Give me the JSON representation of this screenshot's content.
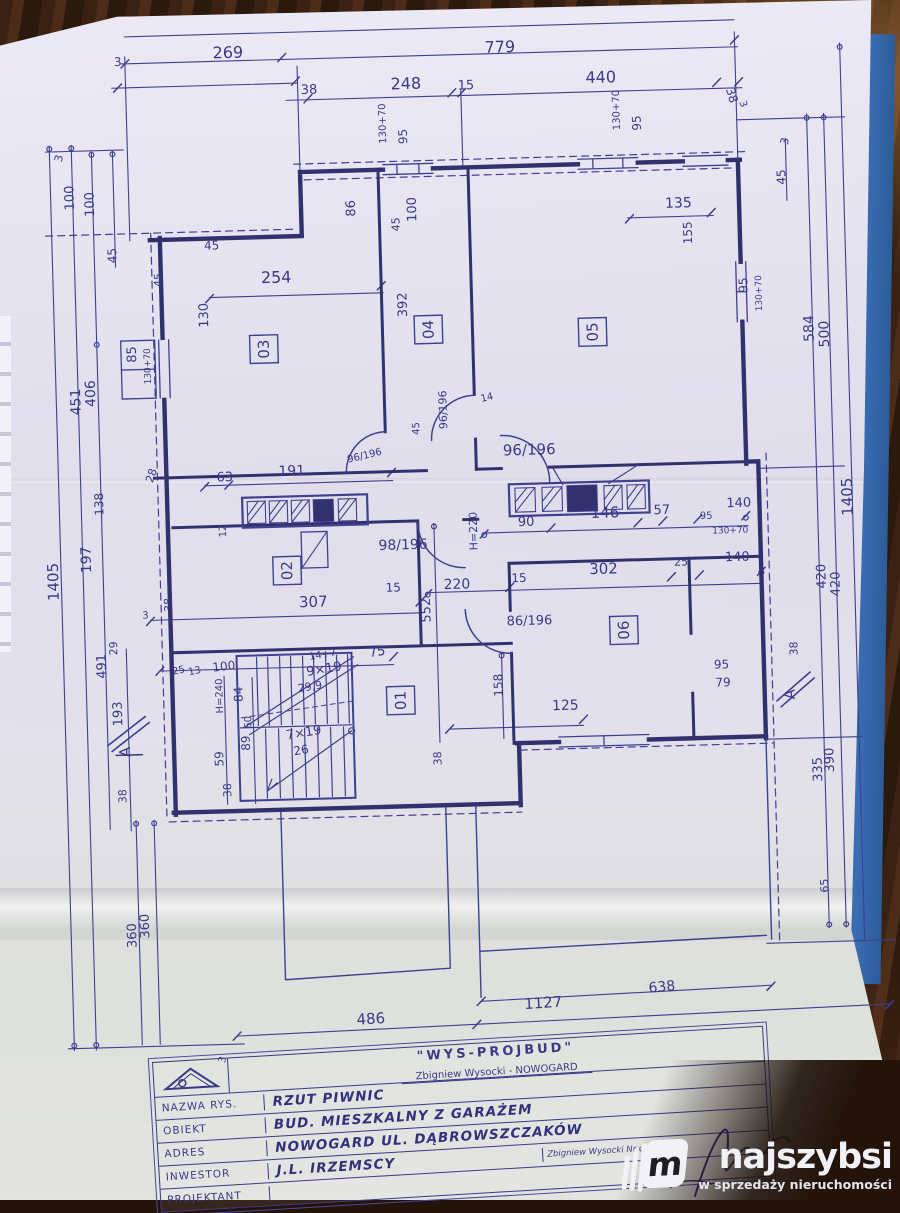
{
  "colors": {
    "ink": "#3a3989",
    "walls": "#32316e",
    "paper": "#e4e1f0",
    "wood": "#3a2114",
    "blue_edge": "#3a6db5",
    "watermark_text": "#f1f1f6"
  },
  "watermark": {
    "logo_letter": "m",
    "brand": "najszybsi",
    "tagline": "w sprzedaży nieruchomości"
  },
  "title_block": {
    "company": "\"WYS-PROJBUD\"",
    "company_sub": "Zbigniew Wysocki - NOWOGARD",
    "rows": [
      {
        "label": "NAZWA RYS.",
        "value": "RZUT PIWNIC"
      },
      {
        "label": "OBIEKT",
        "value": "BUD. MIESZKALNY Z GARAŻEM"
      },
      {
        "label": "ADRES",
        "value": "NOWOGARD UL. DĄBROWSZCZAKÓW"
      },
      {
        "label": "INWESTOR",
        "value": "J.L. IRZEMSCY"
      },
      {
        "label": "PROJEKTANT",
        "value": ""
      }
    ],
    "license_note": "Zbigniew Wysocki  Nr upr. 127/78"
  },
  "plan": {
    "drawing_title": "RZUT PIWNIC",
    "rooms": [
      {
        "id": "03",
        "x": 271,
        "y": 344
      },
      {
        "id": "04",
        "x": 436,
        "y": 329
      },
      {
        "id": "05",
        "x": 600,
        "y": 336
      },
      {
        "id": "02",
        "x": 288,
        "y": 566
      },
      {
        "id": "01",
        "x": 398,
        "y": 699
      },
      {
        "id": "06",
        "x": 623,
        "y": 635
      }
    ],
    "labels": [
      {
        "t": "3",
        "x": 129,
        "y": 57,
        "s": 12
      },
      {
        "t": "269",
        "x": 228,
        "y": 52,
        "s": 16
      },
      {
        "t": "779",
        "x": 500,
        "y": 54,
        "s": 16
      },
      {
        "t": "38",
        "x": 315,
        "y": 90,
        "s": 13
      },
      {
        "t": "248",
        "x": 405,
        "y": 88,
        "s": 16
      },
      {
        "t": "15",
        "x": 472,
        "y": 90,
        "s": 13
      },
      {
        "t": "440",
        "x": 600,
        "y": 87,
        "s": 16
      },
      {
        "t": "38",
        "x": 740,
        "y": 97,
        "r": 75,
        "s": 12
      },
      {
        "t": "3",
        "x": 753,
        "y": 110,
        "r": 75,
        "s": 10
      },
      {
        "t": "130+70",
        "x": 399,
        "y": 142,
        "r": -90,
        "s": 10
      },
      {
        "t": "95",
        "x": 420,
        "y": 143,
        "r": -90,
        "s": 12
      },
      {
        "t": "45",
        "x": 410,
        "y": 230,
        "r": -90,
        "s": 11
      },
      {
        "t": "130+70",
        "x": 633,
        "y": 135,
        "r": -90,
        "s": 10
      },
      {
        "t": "95",
        "x": 654,
        "y": 136,
        "r": -90,
        "s": 12
      },
      {
        "t": "3",
        "x": 800,
        "y": 155,
        "r": -75,
        "s": 11
      },
      {
        "t": "45",
        "x": 797,
        "y": 194,
        "r": -90,
        "s": 12
      },
      {
        "t": "3",
        "x": 74,
        "y": 152,
        "r": -75,
        "s": 11
      },
      {
        "t": "100",
        "x": 85,
        "y": 200,
        "r": -90,
        "s": 13
      },
      {
        "t": "100",
        "x": 105,
        "y": 207,
        "r": -90,
        "s": 13
      },
      {
        "t": "45",
        "x": 126,
        "y": 254,
        "r": -90,
        "s": 12
      },
      {
        "t": "406",
        "x": 101,
        "y": 397,
        "r": -90,
        "s": 14
      },
      {
        "t": "451",
        "x": 86,
        "y": 405,
        "r": -90,
        "s": 14
      },
      {
        "t": "85",
        "x": 143,
        "y": 354,
        "r": -90,
        "s": 13
      },
      {
        "t": "130+70",
        "x": 157,
        "y": 376,
        "r": -90,
        "s": 9
      },
      {
        "t": "45",
        "x": 171,
        "y": 279,
        "r": -90,
        "s": 11
      },
      {
        "t": "138",
        "x": 106,
        "y": 506,
        "r": -90,
        "s": 12
      },
      {
        "t": "197",
        "x": 92,
        "y": 563,
        "r": -90,
        "s": 14
      },
      {
        "t": "1405",
        "x": 59,
        "y": 590,
        "r": -90,
        "s": 15
      },
      {
        "t": "29",
        "x": 116,
        "y": 646,
        "r": -90,
        "s": 11
      },
      {
        "t": "491",
        "x": 104,
        "y": 669,
        "r": -90,
        "s": 13
      },
      {
        "t": "193",
        "x": 119,
        "y": 717,
        "r": -90,
        "s": 13
      },
      {
        "t": "38",
        "x": 121,
        "y": 794,
        "r": -90,
        "s": 11
      },
      {
        "t": "360",
        "x": 140,
        "y": 930,
        "r": -90,
        "s": 13
      },
      {
        "t": "360",
        "x": 127,
        "y": 939,
        "r": -90,
        "s": 13
      },
      {
        "t": "584",
        "x": 821,
        "y": 352,
        "r": -90,
        "s": 14
      },
      {
        "t": "500",
        "x": 836,
        "y": 358,
        "r": -90,
        "s": 14
      },
      {
        "t": "95",
        "x": 756,
        "y": 301,
        "r": -90,
        "s": 12
      },
      {
        "t": "130+70",
        "x": 770,
        "y": 320,
        "r": -90,
        "s": 9
      },
      {
        "t": "155",
        "x": 702,
        "y": 251,
        "r": -90,
        "s": 12
      },
      {
        "t": "135",
        "x": 676,
        "y": 214,
        "s": 14
      },
      {
        "t": "1405",
        "x": 855,
        "y": 527,
        "r": -90,
        "s": 15
      },
      {
        "t": "420",
        "x": 826,
        "y": 599,
        "r": -90,
        "s": 13
      },
      {
        "t": "420",
        "x": 840,
        "y": 607,
        "r": -90,
        "s": 13
      },
      {
        "t": "38",
        "x": 796,
        "y": 665,
        "r": -90,
        "s": 11
      },
      {
        "t": "390",
        "x": 829,
        "y": 783,
        "r": -90,
        "s": 13
      },
      {
        "t": "335",
        "x": 817,
        "y": 792,
        "r": -90,
        "s": 13
      },
      {
        "t": "65",
        "x": 820,
        "y": 903,
        "r": -90,
        "s": 11
      },
      {
        "t": "86",
        "x": 366,
        "y": 214,
        "r": -90,
        "s": 13
      },
      {
        "t": "100",
        "x": 427,
        "y": 221,
        "r": -90,
        "s": 13
      },
      {
        "t": "45",
        "x": 214,
        "y": 243,
        "s": 12
      },
      {
        "t": "254",
        "x": 270,
        "y": 278,
        "s": 16
      },
      {
        "t": "130",
        "x": 216,
        "y": 321,
        "r": -90,
        "s": 13
      },
      {
        "t": "392",
        "x": 415,
        "y": 316,
        "r": -90,
        "s": 13
      },
      {
        "t": "63",
        "x": 220,
        "y": 475,
        "s": 13
      },
      {
        "t": "191",
        "x": 282,
        "y": 471,
        "s": 14
      },
      {
        "t": "96/196",
        "x": 352,
        "y": 460,
        "r": -12,
        "s": 10
      },
      {
        "t": "96/196",
        "x": 452,
        "y": 429,
        "r": -90,
        "s": 11
      },
      {
        "t": "14",
        "x": 487,
        "y": 403,
        "r": -12,
        "s": 10
      },
      {
        "t": "45",
        "x": 424,
        "y": 434,
        "r": -90,
        "s": 10
      },
      {
        "t": "96/196",
        "x": 507,
        "y": 457,
        "s": 15
      },
      {
        "t": "28",
        "x": 156,
        "y": 475,
        "r": -70,
        "s": 11
      },
      {
        "t": "38",
        "x": 172,
        "y": 604,
        "r": -90,
        "s": 11
      },
      {
        "t": "3",
        "x": 142,
        "y": 610,
        "s": 10
      },
      {
        "t": "12",
        "x": 228,
        "y": 531,
        "r": -90,
        "s": 10
      },
      {
        "t": "98/196",
        "x": 380,
        "y": 548,
        "s": 14
      },
      {
        "t": "H=220",
        "x": 479,
        "y": 551,
        "r": -90,
        "s": 11
      },
      {
        "t": "90",
        "x": 520,
        "y": 528,
        "s": 13
      },
      {
        "t": "146",
        "x": 593,
        "y": 522,
        "s": 15
      },
      {
        "t": "57",
        "x": 656,
        "y": 520,
        "s": 13
      },
      {
        "t": "95",
        "x": 702,
        "y": 526,
        "s": 10
      },
      {
        "t": "130+70",
        "x": 714,
        "y": 541,
        "s": 9
      },
      {
        "t": "140",
        "x": 729,
        "y": 515,
        "s": 13
      },
      {
        "t": "220",
        "x": 444,
        "y": 589,
        "s": 14
      },
      {
        "t": "15",
        "x": 386,
        "y": 590,
        "s": 12
      },
      {
        "t": "307",
        "x": 299,
        "y": 603,
        "s": 15
      },
      {
        "t": "552",
        "x": 430,
        "y": 622,
        "r": -90,
        "s": 13
      },
      {
        "t": "15",
        "x": 512,
        "y": 584,
        "s": 12
      },
      {
        "t": "302",
        "x": 590,
        "y": 578,
        "s": 15
      },
      {
        "t": "25",
        "x": 675,
        "y": 572,
        "s": 11
      },
      {
        "t": "140",
        "x": 726,
        "y": 569,
        "s": 13
      },
      {
        "t": "86/196",
        "x": 506,
        "y": 627,
        "s": 13
      },
      {
        "t": "158",
        "x": 500,
        "y": 698,
        "r": -90,
        "s": 12
      },
      {
        "t": "125",
        "x": 549,
        "y": 713,
        "s": 14
      },
      {
        "t": "95",
        "x": 712,
        "y": 676,
        "s": 12
      },
      {
        "t": "79",
        "x": 713,
        "y": 694,
        "s": 12
      },
      {
        "t": "38",
        "x": 437,
        "y": 765,
        "r": -90,
        "s": 11
      },
      {
        "t": "25",
        "x": 171,
        "y": 667,
        "r": -10,
        "s": 10
      },
      {
        "t": "13",
        "x": 187,
        "y": 668,
        "r": -10,
        "s": 10
      },
      {
        "t": "100",
        "x": 211,
        "y": 665,
        "r": -5,
        "s": 12
      },
      {
        "t": "14+7",
        "x": 308,
        "y": 656,
        "r": -8,
        "s": 10
      },
      {
        "t": "75",
        "x": 368,
        "y": 655,
        "r": -8,
        "s": 13
      },
      {
        "t": "9×19",
        "x": 305,
        "y": 672,
        "r": -8,
        "s": 13
      },
      {
        "t": "29,9",
        "x": 296,
        "y": 688,
        "r": -8,
        "s": 11
      },
      {
        "t": "H=240",
        "x": 220,
        "y": 707,
        "r": -90,
        "s": 10
      },
      {
        "t": "84",
        "x": 240,
        "y": 696,
        "r": -90,
        "s": 12
      },
      {
        "t": "60",
        "x": 248,
        "y": 723,
        "r": -90,
        "s": 10
      },
      {
        "t": "89",
        "x": 246,
        "y": 745,
        "r": -90,
        "s": 12
      },
      {
        "t": "7×19",
        "x": 283,
        "y": 735,
        "r": -8,
        "s": 13
      },
      {
        "t": "26",
        "x": 290,
        "y": 751,
        "r": -8,
        "s": 12
      },
      {
        "t": "59",
        "x": 219,
        "y": 760,
        "r": -90,
        "s": 12
      },
      {
        "t": "38",
        "x": 226,
        "y": 791,
        "r": -90,
        "s": 11
      },
      {
        "t": "486",
        "x": 345,
        "y": 1022,
        "r": -2,
        "s": 15
      },
      {
        "t": "1127",
        "x": 513,
        "y": 1011,
        "r": -2,
        "s": 15
      },
      {
        "t": "638",
        "x": 638,
        "y": 998,
        "r": -4,
        "s": 14
      },
      {
        "t": "3",
        "x": 212,
        "y": 1057,
        "r": -75,
        "s": 10
      },
      {
        "t": "A",
        "x": 126,
        "y": 748,
        "r": -90,
        "s": 15
      },
      {
        "t": "A",
        "x": 792,
        "y": 709,
        "r": -90,
        "s": 15
      }
    ]
  }
}
